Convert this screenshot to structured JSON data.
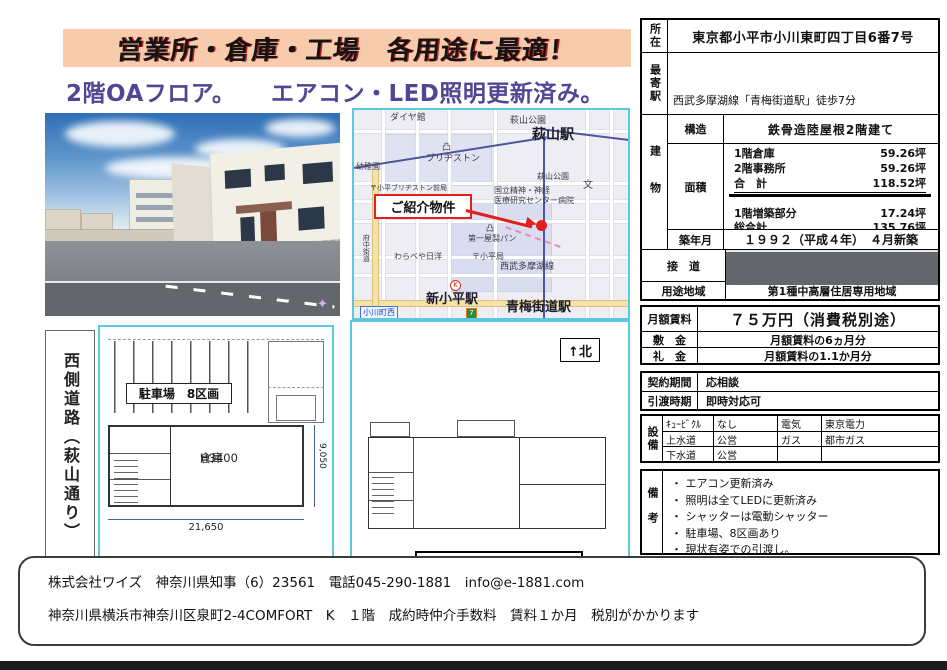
{
  "header": {
    "title": "営業所・倉庫・工場　各用途に最適！",
    "subtitle": "2階OAフロア。　　エアコン・LED照明更新済み。"
  },
  "map": {
    "callout": "ご紹介物件",
    "labels": {
      "daiyakan": "ダイヤ館",
      "hagiyama_park_top": "萩山公園",
      "hagiyama_station": "萩山駅",
      "factory_icon_1": "凸",
      "bridgestone": "ブリヂストン",
      "kindergarten": "幼稚園",
      "post_office_bridgestone": "〒小平ブリヂストン前局",
      "hagiyama_park_mid": "萩山公園",
      "hospital_line1": "国立精神・神経",
      "hospital_line2": "医療研究センター病院",
      "school_mark": "文",
      "factory_icon_2": "凸",
      "daiichiya_bread": "第一屋製パン",
      "warabeya": "わらべや日洋",
      "post_office_kodaira": "〒小平局",
      "seibu_tamako_line": "西武多摩湖線",
      "fuchu_kaido": "府中街道",
      "shin_kodaira_station": "新小平駅",
      "omekaido_station": "青梅街道駅",
      "ogawacho_nishi": "小川町西",
      "store_k": "K",
      "store_7": "7"
    }
  },
  "floorplans": {
    "plan1": {
      "side_label": "西側道路（萩山通り）",
      "parking_label": "駐車場　8区画",
      "room_label_line1": "倉庫",
      "room_label_line2": "H3400",
      "dim_width": "21,650",
      "dim_height": "9,050",
      "caption": "1階　平面図（倉庫）"
    },
    "plan2": {
      "north_label": "↑北",
      "caption": "2階　平面図（事務所）"
    }
  },
  "property": {
    "location_label": "所在",
    "location": "東京都小平市小川東町四丁目6番7号",
    "stations_label": "最寄駅",
    "stations": [
      "西武多摩湖線「青梅街道駅」徒歩7分",
      "西武拝島線　「萩山駅」　　徒歩8分",
      "JR武蔵野線　「新小平駅」　徒歩13分"
    ],
    "building_label": "建物",
    "structure_label": "構造",
    "structure": "鉄骨造陸屋根2階建て",
    "area_label": "面積",
    "areas": [
      {
        "name": "1階倉庫",
        "value": "59.26坪"
      },
      {
        "name": "2階事務所",
        "value": "59.26坪"
      },
      {
        "name": "合　計",
        "value": "118.52坪"
      },
      {
        "name": "1階増築部分",
        "value": "17.24坪"
      },
      {
        "name": "総合計",
        "value": "135.76坪"
      }
    ],
    "built_label": "築年月",
    "built": "１９９２（平成４年）　４月新築",
    "road_label": "接　道",
    "road_line1": "西側：　市道（萩山通り）幅員１１ｍ",
    "road_line2": "に約２１ｍ接道",
    "zoning_label": "用途地域",
    "zoning": "第1種中高層住居専用地域"
  },
  "price": {
    "rent_label": "月額賃料",
    "rent": "７５万円（消費税別途）",
    "deposit_label": "敷　金",
    "deposit": "月額賃料の6ヵ月分",
    "key_money_label": "礼　金",
    "key_money": "月額賃料の1.1か月分"
  },
  "terms": {
    "contract_label": "契約期間",
    "contract": "応相談",
    "handover_label": "引渡時期",
    "handover": "即時対応可"
  },
  "facilities": {
    "label": "設備",
    "rows": [
      [
        "ｷｭｰﾋﾞｸﾙ",
        "なし",
        "電気",
        "東京電力"
      ],
      [
        "上水道",
        "公営",
        "ガス",
        "都市ガス"
      ],
      [
        "下水道",
        "公営",
        "",
        ""
      ]
    ]
  },
  "notes": {
    "label": "備考",
    "items": [
      "・ エアコン更新済み",
      "・ 照明は全てLEDに更新済み",
      "・ シャッターは電動シャッター",
      "・ 駐車場、8区画あり",
      "・ 現状有姿での引渡し。"
    ]
  },
  "footer": {
    "line1": "株式会社ワイズ　神奈川県知事（6）23561　電話045-290-1881　info@e-1881.com",
    "line2": "神奈川県横浜市神奈川区泉町2-4COMFORT　K　１階　成約時仲介手数料　賃料１か月　税別がかかります"
  },
  "colors": {
    "banner-bg": "#F8CBAD",
    "subtitle": "#524594",
    "accent-red": "#E02020",
    "plan-border": "#5BC8E0",
    "rail-blue": "#4A569E",
    "bottom-bar": "#1C1C1C"
  }
}
